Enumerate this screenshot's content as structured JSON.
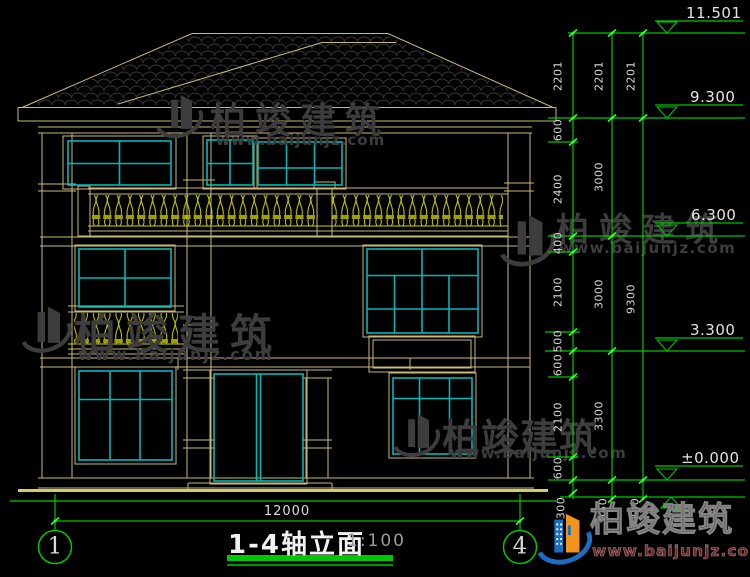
{
  "drawing": {
    "title": "1-4轴立面",
    "scale": "1:100",
    "width_dimension": "12000",
    "grid_bubbles": [
      "1",
      "4"
    ],
    "elevation_markers": [
      "11.501",
      "9.300",
      "6.300",
      "3.300",
      "±0.000"
    ],
    "dimension_chains": {
      "inner": [
        "2201",
        "600",
        "2400",
        "400",
        "2100",
        "500",
        "600",
        "2100",
        "600",
        "300"
      ],
      "middle": [
        "2201",
        "3000",
        "3000",
        "3300",
        "450"
      ],
      "outer": [
        "2201",
        "9300",
        "450"
      ]
    },
    "colors": {
      "background": "#000000",
      "dimension_green": "#00c800",
      "tick_green": "#33ff33",
      "outline_tan": "#c9ba7a",
      "window_cyan": "#00b8b8",
      "railing_yellow": "#d4d400",
      "label_white": "#e0e0e0"
    }
  },
  "watermark": {
    "brand": "柏竣建筑",
    "url": "www.baijunjz.com"
  },
  "footer": {
    "brand": "柏竣建筑",
    "url": "www.baijunjz.com"
  }
}
